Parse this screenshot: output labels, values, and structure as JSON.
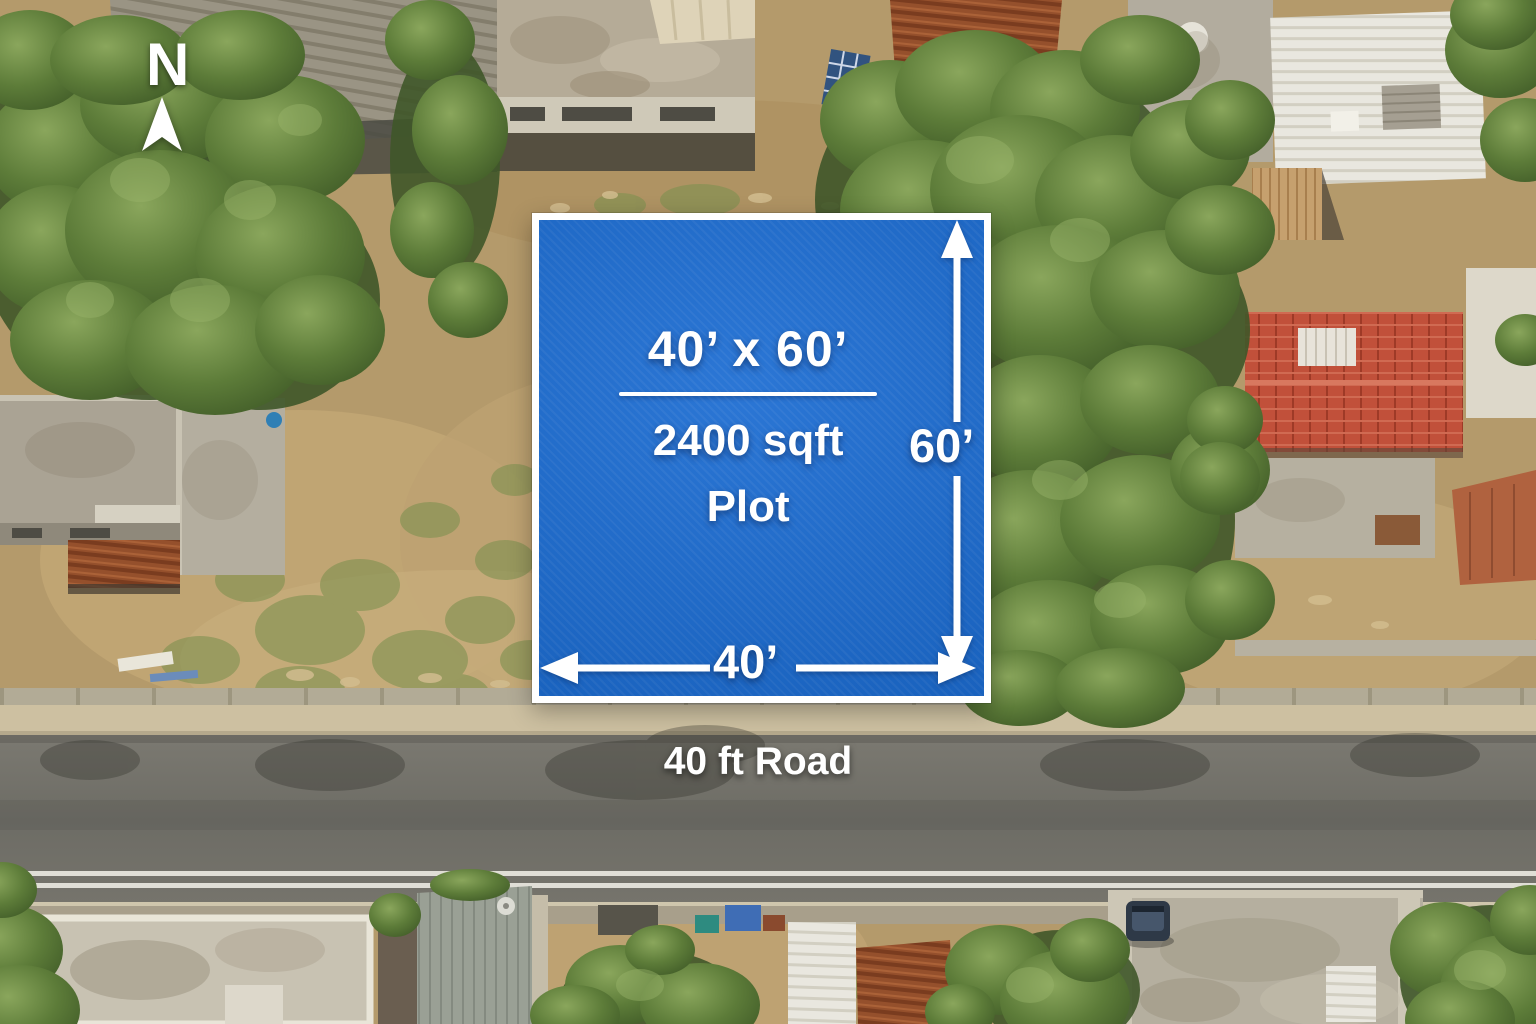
{
  "scene": {
    "description": "Aerial drone photograph of a residential neighborhood with a highlighted vacant plot for sale",
    "compass": {
      "label": "N"
    },
    "plot": {
      "size_label": "40’ x 60’",
      "area_label": "2400 sqft",
      "type_label": "Plot",
      "depth_label": "60’",
      "frontage_label": "40’",
      "colors": {
        "fill": "#1b6cd2",
        "border": "#ffffff",
        "text": "#ffffff"
      }
    },
    "road": {
      "label": "40 ft Road",
      "label_color": "#ffffff"
    }
  }
}
